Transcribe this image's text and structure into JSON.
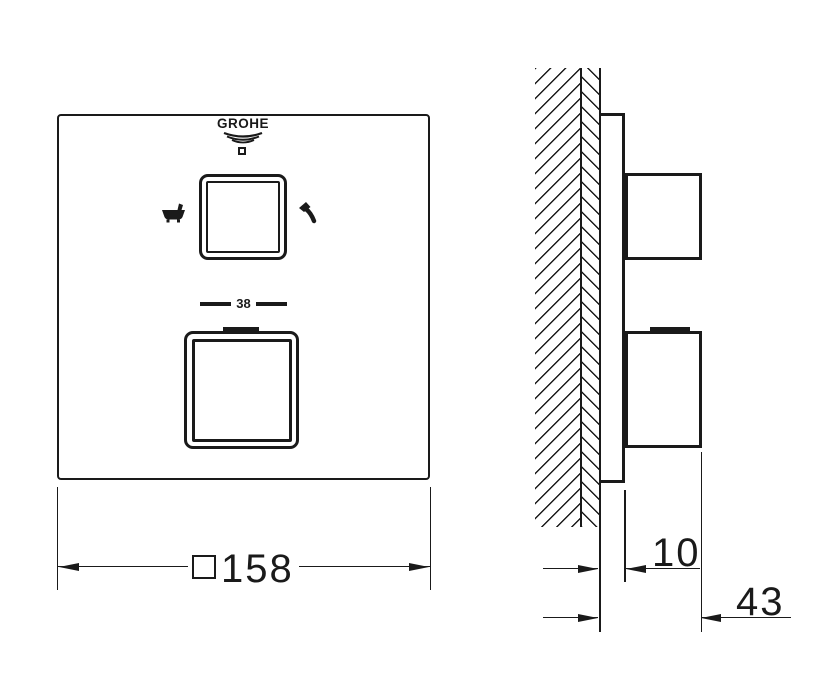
{
  "drawing": {
    "brand": "GROHE",
    "front_view": {
      "temperature_mark": "38",
      "upper_knob_left_icon": "bathtub-icon",
      "upper_knob_right_icon": "hand-shower-icon",
      "logo_icon": "grohe-waves-icon",
      "width_dimension": {
        "symbol": "square",
        "value": "158"
      }
    },
    "side_view": {
      "plate_depth_dimension": "10",
      "total_depth_dimension": "43"
    },
    "colors": {
      "line": "#1a1a1a",
      "background": "#ffffff"
    }
  }
}
